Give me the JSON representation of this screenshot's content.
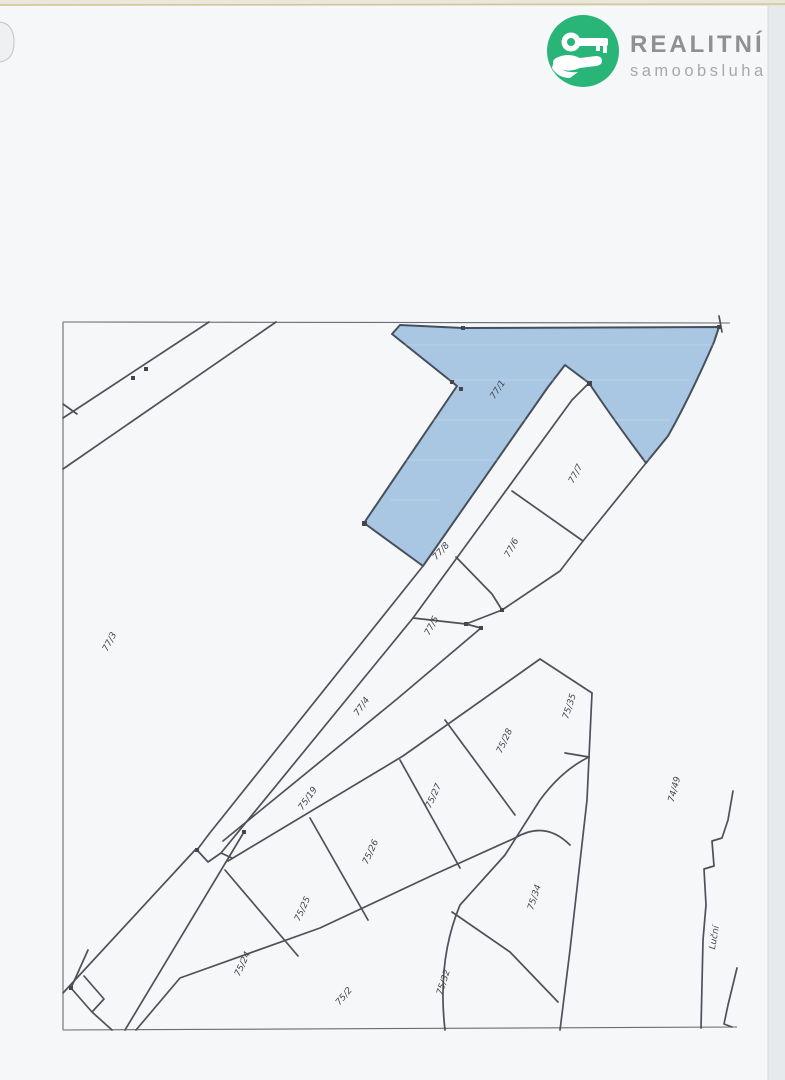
{
  "logo": {
    "brand": "REALITNÍ",
    "subtitle": "samoobsluha",
    "brand_color": "#29b478",
    "text_color": "#8f9094",
    "subtitle_color": "#a7a8ac",
    "icon": "key-in-hand-icon"
  },
  "map": {
    "type": "cadastral-parcel-map-scan",
    "highlighted_parcel": "77/1",
    "street_label": "Luční",
    "colors": {
      "highlight_fill": "#a9c7e3",
      "boundary_line": "#50505a",
      "label_text": "#45454f",
      "paper": "#f5f7f8"
    },
    "labels": [
      {
        "text": "77/1",
        "x": 500,
        "y": 391,
        "rot": -57
      },
      {
        "text": "77/3",
        "x": 112,
        "y": 643,
        "rot": -62
      },
      {
        "text": "77/7",
        "x": 578,
        "y": 475,
        "rot": -62
      },
      {
        "text": "77/6",
        "x": 514,
        "y": 549,
        "rot": -62
      },
      {
        "text": "77/8",
        "x": 443,
        "y": 553,
        "rot": -48
      },
      {
        "text": "77/5",
        "x": 434,
        "y": 627,
        "rot": -62
      },
      {
        "text": "77/4",
        "x": 364,
        "y": 708,
        "rot": -55
      },
      {
        "text": "75/19",
        "x": 310,
        "y": 800,
        "rot": -55
      },
      {
        "text": "75/35",
        "x": 572,
        "y": 707,
        "rot": -72
      },
      {
        "text": "75/28",
        "x": 507,
        "y": 742,
        "rot": -65
      },
      {
        "text": "75/27",
        "x": 436,
        "y": 797,
        "rot": -65
      },
      {
        "text": "75/26",
        "x": 373,
        "y": 853,
        "rot": -65
      },
      {
        "text": "75/25",
        "x": 305,
        "y": 910,
        "rot": -65
      },
      {
        "text": "75/24",
        "x": 245,
        "y": 965,
        "rot": -65
      },
      {
        "text": "75/2",
        "x": 346,
        "y": 998,
        "rot": -50
      },
      {
        "text": "75/32",
        "x": 446,
        "y": 983,
        "rot": -72
      },
      {
        "text": "75/34",
        "x": 537,
        "y": 898,
        "rot": -72
      },
      {
        "text": "74/49",
        "x": 677,
        "y": 790,
        "rot": -75
      },
      {
        "text": "Luční",
        "x": 717,
        "y": 938,
        "rot": -80
      }
    ]
  }
}
